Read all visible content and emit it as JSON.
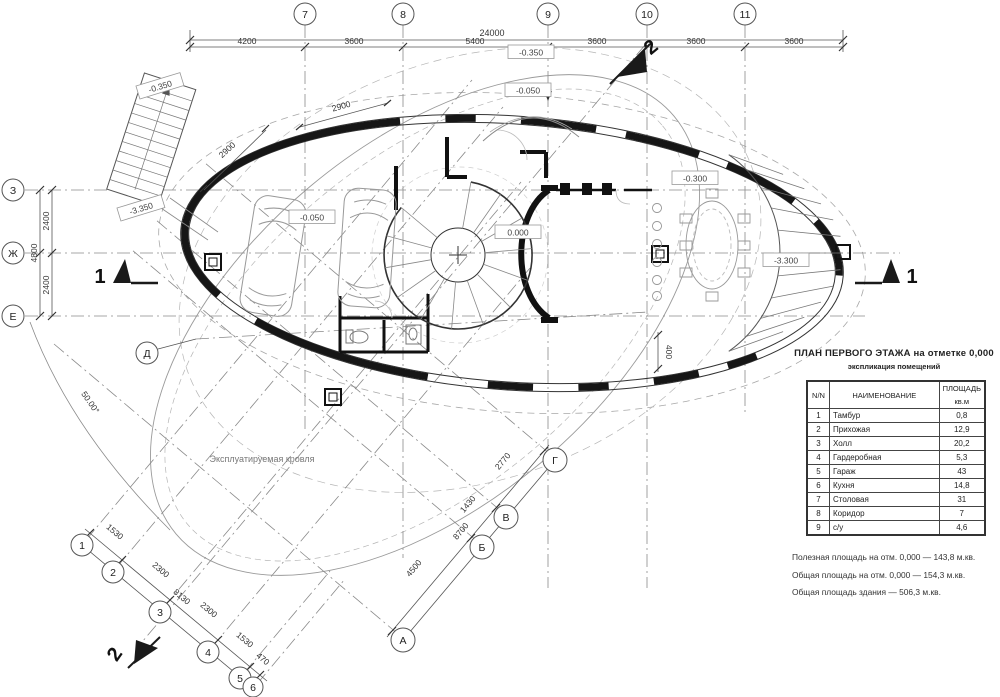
{
  "title": {
    "main": "ПЛАН ПЕРВОГО ЭТАЖА на отметке 0,000",
    "sub": "экспликация помещений"
  },
  "table": {
    "col_num": "N/N",
    "col_name": "НАИМЕНОВАНИЕ",
    "col_area1": "ПЛОЩАДЬ",
    "col_area2": "кв.м",
    "rows": [
      {
        "n": "1",
        "name": "Тамбур",
        "area": "0,8"
      },
      {
        "n": "2",
        "name": "Прихожая",
        "area": "12,9"
      },
      {
        "n": "3",
        "name": "Холл",
        "area": "20,2"
      },
      {
        "n": "4",
        "name": "Гардеробная",
        "area": "5,3"
      },
      {
        "n": "5",
        "name": "Гараж",
        "area": "43"
      },
      {
        "n": "6",
        "name": "Кухня",
        "area": "14,8"
      },
      {
        "n": "7",
        "name": "Столовая",
        "area": "31"
      },
      {
        "n": "8",
        "name": "Коридор",
        "area": "7"
      },
      {
        "n": "9",
        "name": "с/у",
        "area": "4,6"
      }
    ]
  },
  "notes": [
    "Полезная площадь на отм. 0,000 —  143,8 м.кв.",
    "Общая площадь на отм. 0,000 —  154,3 м.кв.",
    "Общая площадь здания —  506,3 м.кв."
  ],
  "axes": {
    "top": [
      "7",
      "8",
      "9",
      "10",
      "11"
    ],
    "left": [
      "З",
      "Ж",
      "Е"
    ],
    "letter_d": "Д",
    "diag_numbers": [
      "1",
      "2",
      "3",
      "4",
      "5",
      "6"
    ],
    "diag_letters": [
      "А",
      "Б",
      "В",
      "Г"
    ]
  },
  "dims": {
    "top_total": "24000",
    "top_segments": [
      "4200",
      "3600",
      "5400",
      "3600",
      "3600",
      "3600"
    ],
    "left_total": "4800",
    "left_segments": [
      "2400",
      "2400"
    ],
    "diag_num_total": "8130",
    "diag_num_segments": [
      "1530",
      "2300",
      "2300",
      "1530",
      "470"
    ],
    "diag_let_total": "8700",
    "diag_let_segments": [
      "4500",
      "1430",
      "2770"
    ],
    "wall": [
      "2900",
      "2900"
    ],
    "misc": [
      "400"
    ],
    "angle": "50.00°"
  },
  "elevations": [
    "-0.350",
    "-3.350",
    "-0.050",
    "-0.350",
    "-0.050",
    "0.000",
    "-0.300",
    "-3.300"
  ],
  "sections": {
    "one": "1",
    "two": "2"
  },
  "labels": {
    "roof": "Эксплуатируемая кровля"
  }
}
